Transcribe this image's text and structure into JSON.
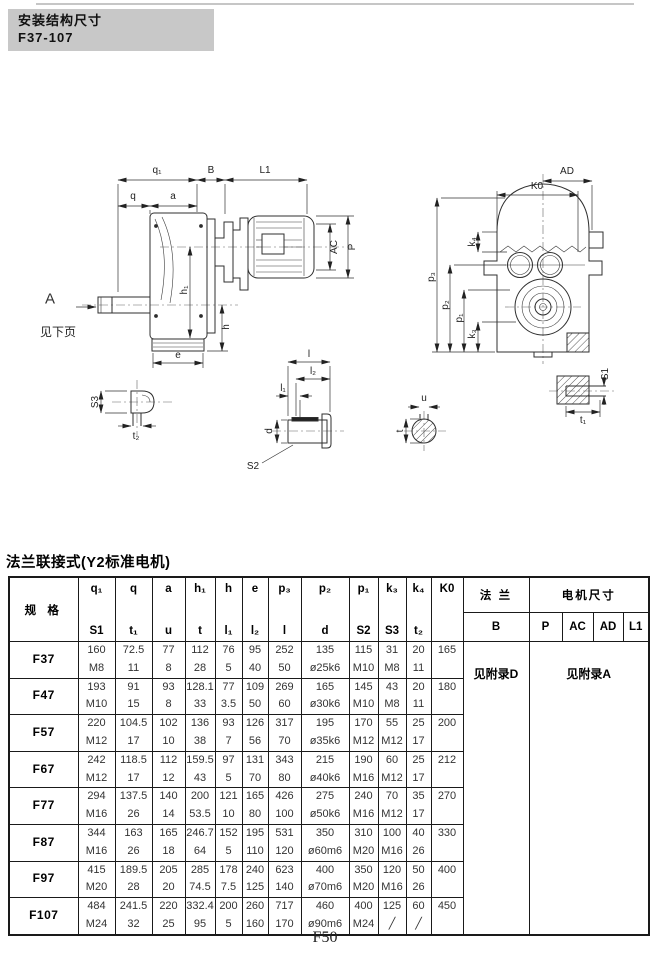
{
  "page": {
    "header_box": {
      "line1": "安装结构尺寸",
      "line2": "F37-107"
    },
    "section_title": "法兰联接式(Y2标准电机)",
    "page_number": "F50"
  },
  "colors": {
    "header_box_bg": "#c8c8c8",
    "line_color": "#2f2f2f"
  },
  "drawing": {
    "side_view": {
      "q1": "q₁",
      "b": "B",
      "l1": "L1",
      "q": "q",
      "a": "a",
      "ac": "AC",
      "p": "P",
      "h1": "h₁",
      "h": "h",
      "e": "e",
      "view_label": "A",
      "see_next_page": "见下页"
    },
    "end_view": {
      "k0": "K0",
      "ad": "AD",
      "p3": "p₃",
      "p2": "p₂",
      "p1": "p₁",
      "k4": "k₄",
      "k3": "k₃"
    },
    "details": {
      "s3": "S3",
      "t2": "t₂",
      "l": "l",
      "l2": "l₂",
      "l1": "l₁",
      "d": "d",
      "s2": "S2",
      "u": "u",
      "t": "t",
      "s1": "S1",
      "t1": "t₁"
    }
  },
  "table": {
    "spec_header": "规 格",
    "flange_header": "法 兰",
    "motor_header": "电机尺寸",
    "col_top": [
      "q₁",
      "q",
      "a",
      "h₁",
      "h",
      "e",
      "p₃",
      "p₂",
      "p₁",
      "k₃",
      "k₄",
      "K0"
    ],
    "col_bottom": [
      "S1",
      "t₁",
      "u",
      "t",
      "l₁",
      "l₂",
      "l",
      "d",
      "S2",
      "S3",
      "t₂",
      ""
    ],
    "flange_sub": "B",
    "motor_sub": [
      "P",
      "AC",
      "AD",
      "L1"
    ],
    "flange_note": "见附录D",
    "motor_note": "见附录A",
    "rows": [
      {
        "spec": "F37",
        "k0": "165",
        "line1": [
          "160",
          "72.5",
          "77",
          "112",
          "76",
          "95",
          "252",
          "135",
          "115",
          "31",
          "20"
        ],
        "line2": [
          "M8",
          "11",
          "8",
          "28",
          "5",
          "40",
          "50",
          "ø25k6",
          "M10",
          "M8",
          "11"
        ]
      },
      {
        "spec": "F47",
        "k0": "180",
        "line1": [
          "193",
          "91",
          "93",
          "128.1",
          "77",
          "109",
          "269",
          "165",
          "145",
          "43",
          "20"
        ],
        "line2": [
          "M10",
          "15",
          "8",
          "33",
          "3.5",
          "50",
          "60",
          "ø30k6",
          "M10",
          "M8",
          "11"
        ]
      },
      {
        "spec": "F57",
        "k0": "200",
        "line1": [
          "220",
          "104.5",
          "102",
          "136",
          "93",
          "126",
          "317",
          "195",
          "170",
          "55",
          "25"
        ],
        "line2": [
          "M12",
          "17",
          "10",
          "38",
          "7",
          "56",
          "70",
          "ø35k6",
          "M12",
          "M12",
          "17"
        ]
      },
      {
        "spec": "F67",
        "k0": "212",
        "line1": [
          "242",
          "118.5",
          "112",
          "159.5",
          "97",
          "131",
          "343",
          "215",
          "190",
          "60",
          "25"
        ],
        "line2": [
          "M12",
          "17",
          "12",
          "43",
          "5",
          "70",
          "80",
          "ø40k6",
          "M16",
          "M12",
          "17"
        ]
      },
      {
        "spec": "F77",
        "k0": "270",
        "line1": [
          "294",
          "137.5",
          "140",
          "200",
          "121",
          "165",
          "426",
          "275",
          "240",
          "70",
          "35"
        ],
        "line2": [
          "M16",
          "26",
          "14",
          "53.5",
          "10",
          "80",
          "100",
          "ø50k6",
          "M16",
          "M12",
          "17"
        ]
      },
      {
        "spec": "F87",
        "k0": "330",
        "line1": [
          "344",
          "163",
          "165",
          "246.7",
          "152",
          "195",
          "531",
          "350",
          "310",
          "100",
          "40"
        ],
        "line2": [
          "M16",
          "26",
          "18",
          "64",
          "5",
          "110",
          "120",
          "ø60m6",
          "M20",
          "M16",
          "26"
        ]
      },
      {
        "spec": "F97",
        "k0": "400",
        "line1": [
          "415",
          "189.5",
          "205",
          "285",
          "178",
          "240",
          "623",
          "400",
          "350",
          "120",
          "50"
        ],
        "line2": [
          "M20",
          "28",
          "20",
          "74.5",
          "7.5",
          "125",
          "140",
          "ø70m6",
          "M20",
          "M16",
          "26"
        ]
      },
      {
        "spec": "F107",
        "k0": "450",
        "line1": [
          "484",
          "241.5",
          "220",
          "332.4",
          "200",
          "260",
          "717",
          "460",
          "400",
          "125",
          "60"
        ],
        "line2": [
          "M24",
          "32",
          "25",
          "95",
          "5",
          "160",
          "170",
          "ø90m6",
          "M24",
          "╱",
          "╱"
        ]
      }
    ]
  }
}
